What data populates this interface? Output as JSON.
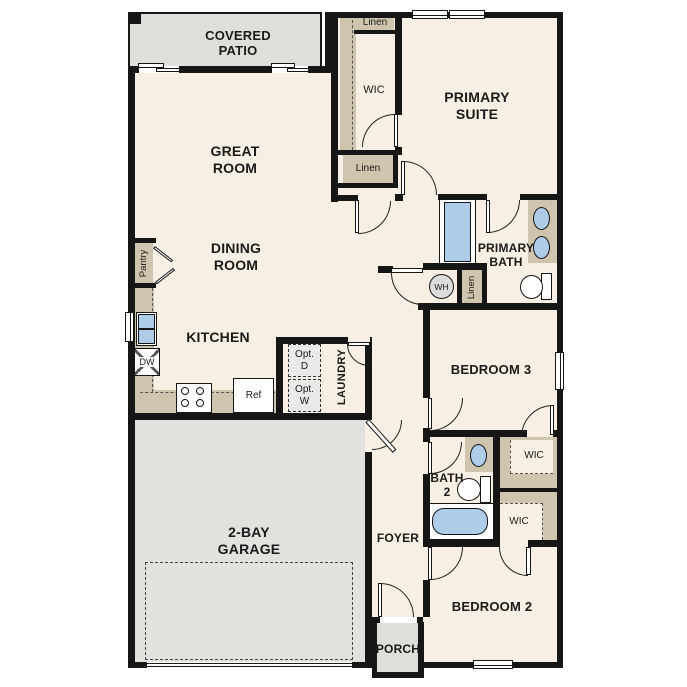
{
  "plan_title": "Single-story floor plan",
  "labels": {
    "covered_patio": "COVERED\nPATIO",
    "great_room": "GREAT\nROOM",
    "dining_room": "DINING\nROOM",
    "kitchen": "KITCHEN",
    "pantry": "Pantry",
    "dw": "DW",
    "ref": "Ref",
    "opt_d": "Opt.\nD",
    "opt_w": "Opt.\nW",
    "laundry": "LAUNDRY",
    "wic_primary": "WIC",
    "wic_bedroom3": "WIC",
    "wic_bedroom2": "WIC",
    "linen_top": "Linen",
    "linen_mid": "Linen",
    "linen_hall": "Linen",
    "primary_suite": "PRIMARY\nSUITE",
    "primary_bath": "PRIMARY\nBATH",
    "water_heater": "WH",
    "bedroom3": "BEDROOM 3",
    "bath2": "BATH\n2",
    "bedroom2": "BEDROOM 2",
    "foyer": "FOYER",
    "porch": "PORCH",
    "garage": "2-BAY\nGARAGE"
  },
  "colors": {
    "floor": "#f7efe3",
    "wall": "#161616",
    "patio_gray": "#e0ded8",
    "garage_gray": "#e3e1dd",
    "closet_tan": "#cfc4ae",
    "fixture_blue": "#aecbe8",
    "appliance_gray": "#e9e9e7"
  }
}
